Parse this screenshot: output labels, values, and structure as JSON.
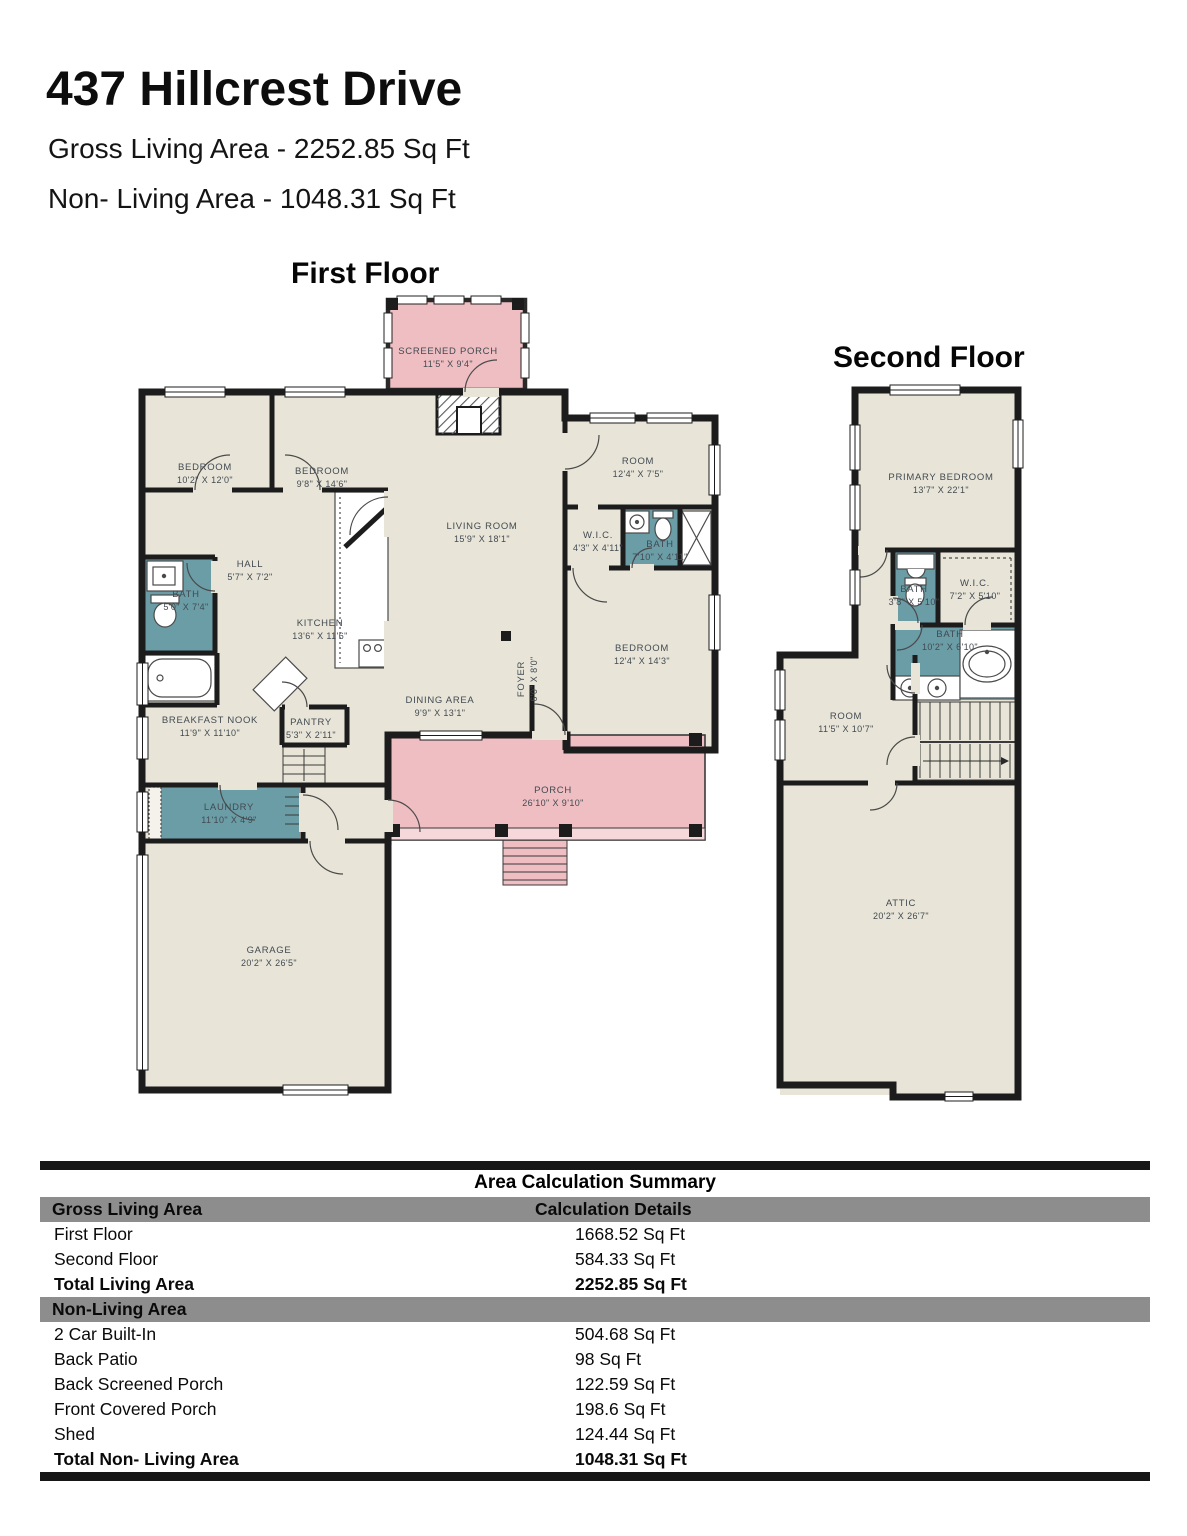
{
  "header": {
    "title": "437 Hillcrest Drive",
    "gross_living": "Gross Living Area - 2252.85 Sq Ft",
    "non_living": "Non- Living Area - 1048.31 Sq Ft"
  },
  "floors": {
    "first": {
      "heading": "First Floor",
      "rooms": {
        "screened_porch": {
          "name": "SCREENED PORCH",
          "dims": "11'5\" X 9'4\""
        },
        "bedroom_left": {
          "name": "BEDROOM",
          "dims": "10'2\" X 12'0\""
        },
        "bedroom_mid": {
          "name": "BEDROOM",
          "dims": "9'8\" X 14'6\""
        },
        "room": {
          "name": "ROOM",
          "dims": "12'4\" X 7'5\""
        },
        "living_room": {
          "name": "LIVING ROOM",
          "dims": "15'9\" X 18'1\""
        },
        "wic": {
          "name": "W.I.C.",
          "dims": "4'3\" X 4'11\""
        },
        "bath_hall": {
          "name": "BATH",
          "dims": "7'10\" X 4'11\""
        },
        "hall": {
          "name": "HALL",
          "dims": "5'7\" X 7'2\""
        },
        "bath_left": {
          "name": "BATH",
          "dims": "5'0\" X 7'4\""
        },
        "kitchen": {
          "name": "KITCHEN",
          "dims": "13'6\" X 11'6\""
        },
        "bedroom_right": {
          "name": "BEDROOM",
          "dims": "12'4\" X 14'3\""
        },
        "breakfast_nook": {
          "name": "BREAKFAST NOOK",
          "dims": "11'9\" X 11'10\""
        },
        "pantry": {
          "name": "PANTRY",
          "dims": "5'3\" X 2'11\""
        },
        "foyer": {
          "name": "FOYER",
          "dims": "6'0\" X 8'0\""
        },
        "dining_area": {
          "name": "DINING AREA",
          "dims": "9'9\" X 13'1\""
        },
        "laundry": {
          "name": "LAUNDRY",
          "dims": "11'10\" X 4'9\""
        },
        "porch": {
          "name": "PORCH",
          "dims": "26'10\" X 9'10\""
        },
        "garage": {
          "name": "GARAGE",
          "dims": "20'2\" X 26'5\""
        }
      }
    },
    "second": {
      "heading": "Second Floor",
      "rooms": {
        "primary_bedroom": {
          "name": "PRIMARY BEDROOM",
          "dims": "13'7\" X 22'1\""
        },
        "bath_small": {
          "name": "BATH",
          "dims": "3'8\" X 5'10\""
        },
        "wic": {
          "name": "W.I.C.",
          "dims": "7'2\" X 5'10\""
        },
        "bath_primary": {
          "name": "BATH",
          "dims": "10'2\" X 6'10\""
        },
        "room": {
          "name": "ROOM",
          "dims": "11'5\" X 10'7\""
        },
        "attic": {
          "name": "ATTIC",
          "dims": "20'2\" X 26'7\""
        }
      }
    }
  },
  "summary": {
    "title": "Area Calculation Summary",
    "gross_header": {
      "label": "Gross Living Area",
      "details": "Calculation Details"
    },
    "gross_rows": [
      {
        "label": "First Floor",
        "value": "1668.52 Sq Ft"
      },
      {
        "label": "Second Floor",
        "value": "584.33 Sq Ft"
      },
      {
        "label": "Total Living Area",
        "value": "2252.85 Sq Ft"
      }
    ],
    "non_living_header": "Non-Living Area",
    "non_living_rows": [
      {
        "label": "2 Car Built-In",
        "value": "504.68 Sq Ft"
      },
      {
        "label": "Back Patio",
        "value": "98 Sq Ft"
      },
      {
        "label": "Back Screened Porch",
        "value": "122.59 Sq Ft"
      },
      {
        "label": "Front Covered Porch",
        "value": "198.6 Sq Ft"
      },
      {
        "label": "Shed",
        "value": "124.44 Sq Ft"
      },
      {
        "label": "Total Non- Living Area",
        "value": "1048.31 Sq Ft"
      }
    ]
  },
  "colors": {
    "room_fill": "#e8e5d8",
    "porch_fill": "#eebec2",
    "bath_fill": "#6b9da7",
    "wall": "#1c1c1c",
    "table_band": "#8d8d8d"
  }
}
